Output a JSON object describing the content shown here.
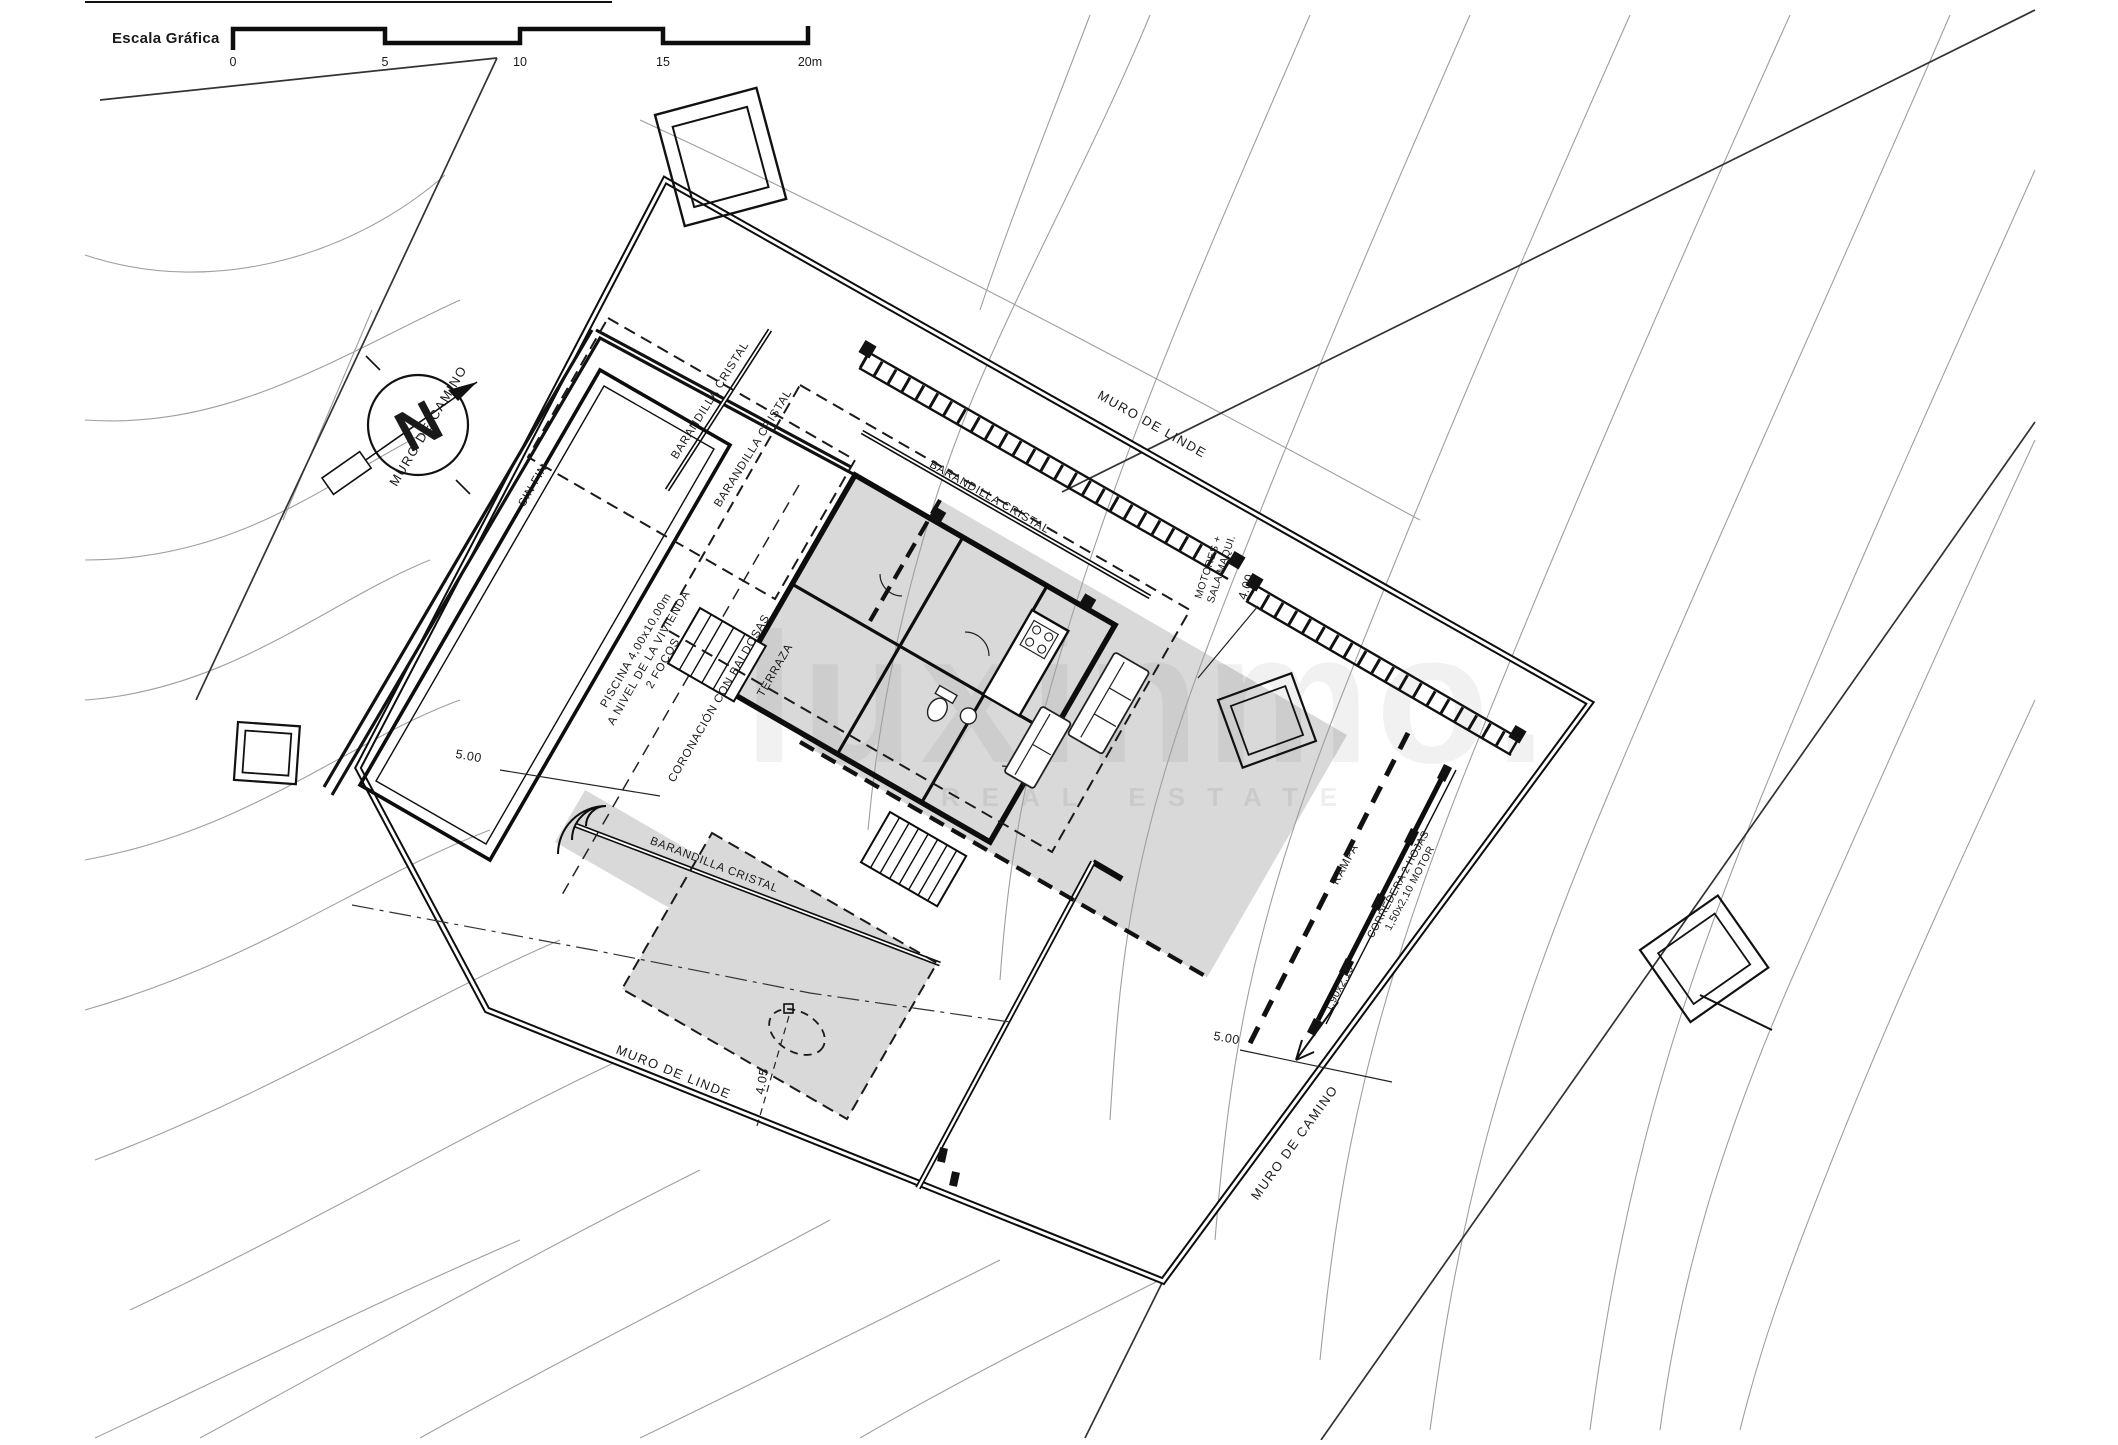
{
  "plan": {
    "scale": {
      "label": "Escala Gráfica",
      "ticks": [
        "0",
        "5",
        "10",
        "15",
        "20m"
      ]
    },
    "compass_letter": "N",
    "walls": {
      "linde": "MURO DE LINDE",
      "camino": "MURO DE CAMINO"
    },
    "features": {
      "barandilla": "BARANDILLA CRISTAL",
      "sin_fin": "SIN FIN",
      "piscina": [
        "PISCINA 4,00x10,00m",
        "A NIVEL DE LA VIVIENDA",
        "2 FOCOS"
      ],
      "coronacion": "CORONACIÓN CON BALDOSAS",
      "terraza": "TERRAZA",
      "motores": [
        "MOTORES +",
        "SALA MAQUI."
      ],
      "rampa": "RAMPA",
      "corredera": [
        "CORREDERA 2 HOJAS",
        "1,50x2,10 MOTOR"
      ],
      "gate_dim": "1,90x2,15"
    },
    "dims": {
      "d400": "4.00",
      "d500": "5.00",
      "d405": "4.05"
    },
    "watermark": {
      "name": "luxinmo.",
      "tagline": "REAL ESTATE"
    }
  }
}
